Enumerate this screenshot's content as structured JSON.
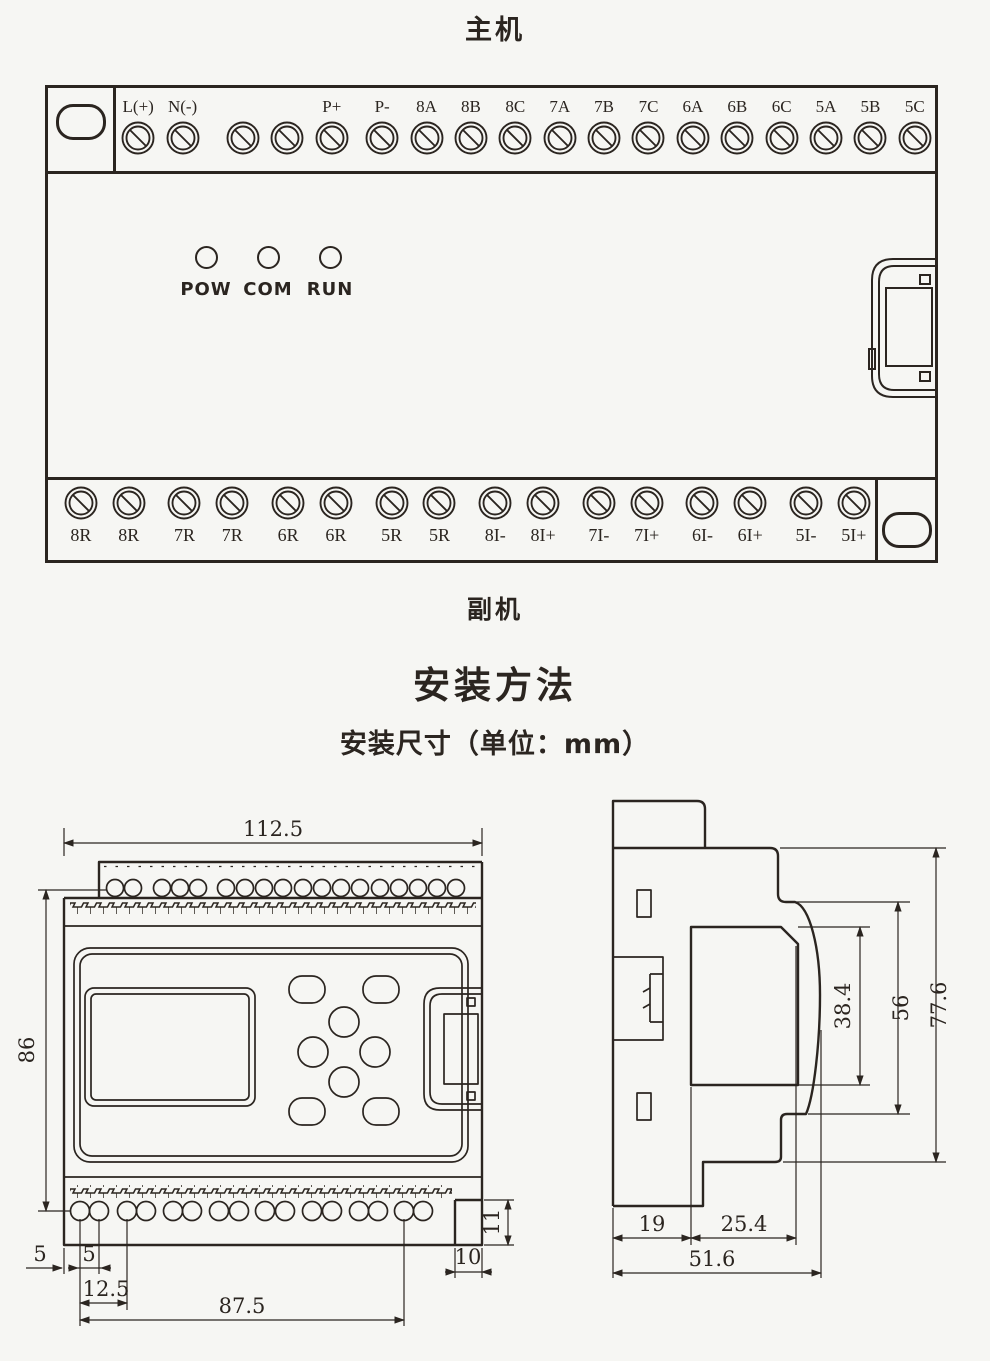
{
  "titles": {
    "main_unit": "主机",
    "sub_unit": "副机",
    "install_heading": "安装方法",
    "install_subheading": "安装尺寸（单位：mm）"
  },
  "device": {
    "top_terminals": [
      "L(+)",
      "N(-)",
      "",
      "",
      "P+",
      "P-",
      "8A",
      "8B",
      "8C",
      "7A",
      "7B",
      "7C",
      "6A",
      "6B",
      "6C",
      "5A",
      "5B",
      "5C"
    ],
    "bottom_terminals": [
      "8R",
      "8R",
      "7R",
      "7R",
      "6R",
      "6R",
      "5R",
      "5R",
      "8I-",
      "8I+",
      "7I-",
      "7I+",
      "6I-",
      "6I+",
      "5I-",
      "5I+"
    ],
    "leds": [
      "POW",
      "COM",
      "RUN"
    ]
  },
  "dimensions": {
    "front": {
      "overall_width": "112.5",
      "hole_row_spacing": "86",
      "edge_to_hole": "5",
      "hole_pitch": "5",
      "hole_pitch_double": "12.5",
      "hole_span": "87.5",
      "notch_width": "10",
      "notch_height": "11"
    },
    "side": {
      "base_depth": "19",
      "front_depth": "25.4",
      "total_depth": "51.6",
      "window_height": "38.4",
      "body_height": "56",
      "total_height": "77.6"
    }
  },
  "colors": {
    "line": "#2b2520",
    "background": "#f6f6f3"
  }
}
